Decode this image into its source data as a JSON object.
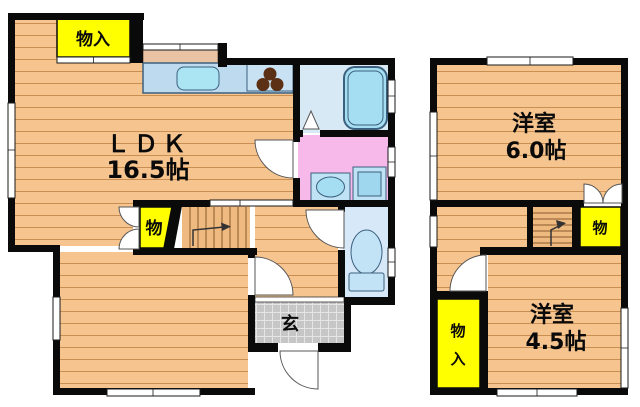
{
  "floorplan": {
    "floor1": {
      "ldk_name": "ＬＤＫ",
      "ldk_size": "16.5帖",
      "closet_top_label": "物入",
      "closet_stairs_label": "物",
      "entrance_label": "玄"
    },
    "floor2": {
      "room_north_name": "洋室",
      "room_north_size": "6.0帖",
      "room_south_name": "洋室",
      "room_south_size": "4.5帖",
      "closet_hall_label": "物",
      "closet_tall_char1": "物",
      "closet_tall_char2": "入"
    },
    "colors": {
      "floor_orange": "#F5C48F",
      "floor_line": "#C88E52",
      "closet_yellow": "#FFFF00",
      "bathroom_blue": "#D7E9F5",
      "washroom_pink": "#F7B9E9",
      "toilet_blue": "#D7E8F8",
      "kitchen_counter_blue": "#BDDAEF",
      "fixture_aqua": "#A5DEF2",
      "entrance_gray": "#C6C6C6",
      "wall_black": "#0A0A0A"
    }
  }
}
